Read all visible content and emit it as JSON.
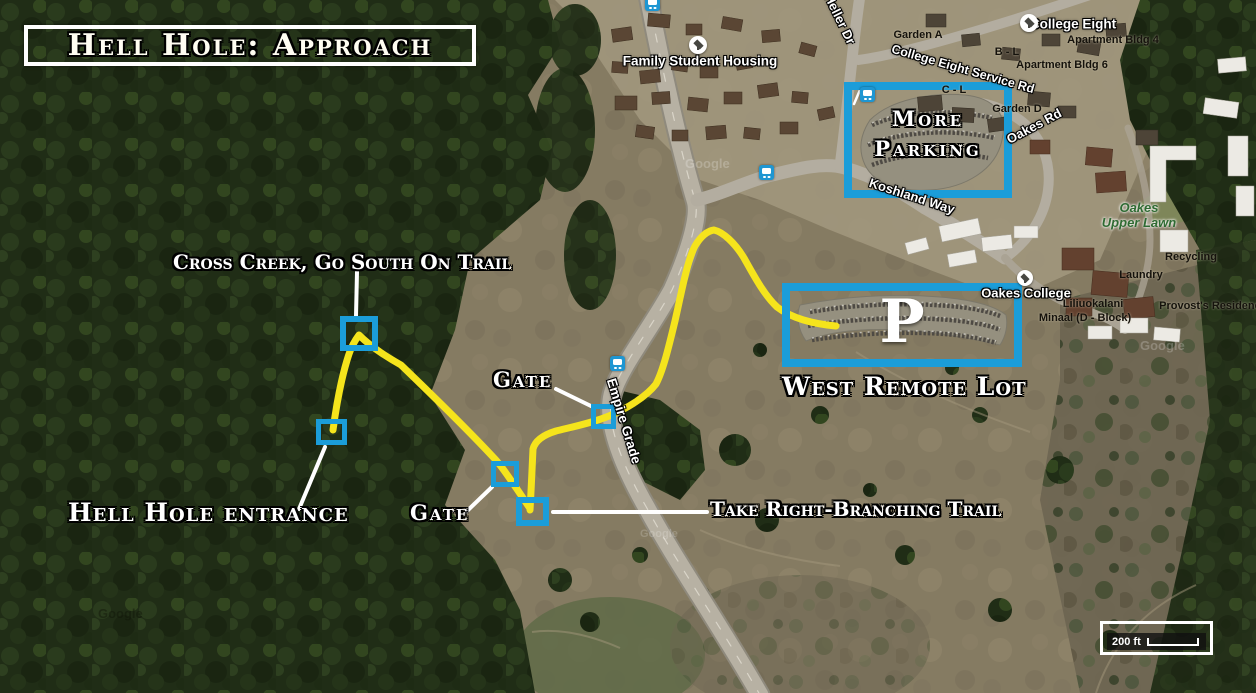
{
  "title": "Hell Hole: Approach",
  "annotations": {
    "cross_creek_label": "Cross Creek, Go South On Trail",
    "gate_upper_label": "Gate",
    "gate_lower_label": "Gate",
    "entrance_label": "Hell Hole entrance",
    "take_right_label": "Take Right-Branching Trail",
    "more_parking_line1": "More",
    "more_parking_line2": "Parking",
    "west_remote_label": "West Remote Lot",
    "parking_symbol": "P"
  },
  "map_labels": {
    "family_student_housing": "Family Student Housing",
    "college_eight": "College Eight",
    "oakes_college": "Oakes College",
    "garden_a": "Garden A",
    "garden_d": "Garden D",
    "b_l": "B - L",
    "c_l": "C - L",
    "apartment_bldg_4": "Apartment Bldg 4",
    "apartment_bldg_6": "Apartment Bldg 6",
    "oakes_upper_lawn_1": "Oakes",
    "oakes_upper_lawn_2": "Upper Lawn",
    "laundry": "Laundry",
    "recycling": "Recycling",
    "provosts_residence": "Provost's Residence",
    "liliuokalani": "Liliuokalani",
    "minaal_d_block": "Minaal (D - Block)"
  },
  "roads": {
    "heller_dr": "Heller Dr",
    "empire_grade": "Empire Grade",
    "koshland_way": "Koshland Way",
    "college_eight_service_rd": "College Eight Service Rd",
    "oakes_rd": "Oakes Rd"
  },
  "scale_bar": {
    "label": "200 ft"
  },
  "watermark": "Google",
  "colors": {
    "annotation_blue": "#1b9dd9",
    "trail_yellow": "#f5e41c",
    "leader_white": "#ffffff"
  }
}
